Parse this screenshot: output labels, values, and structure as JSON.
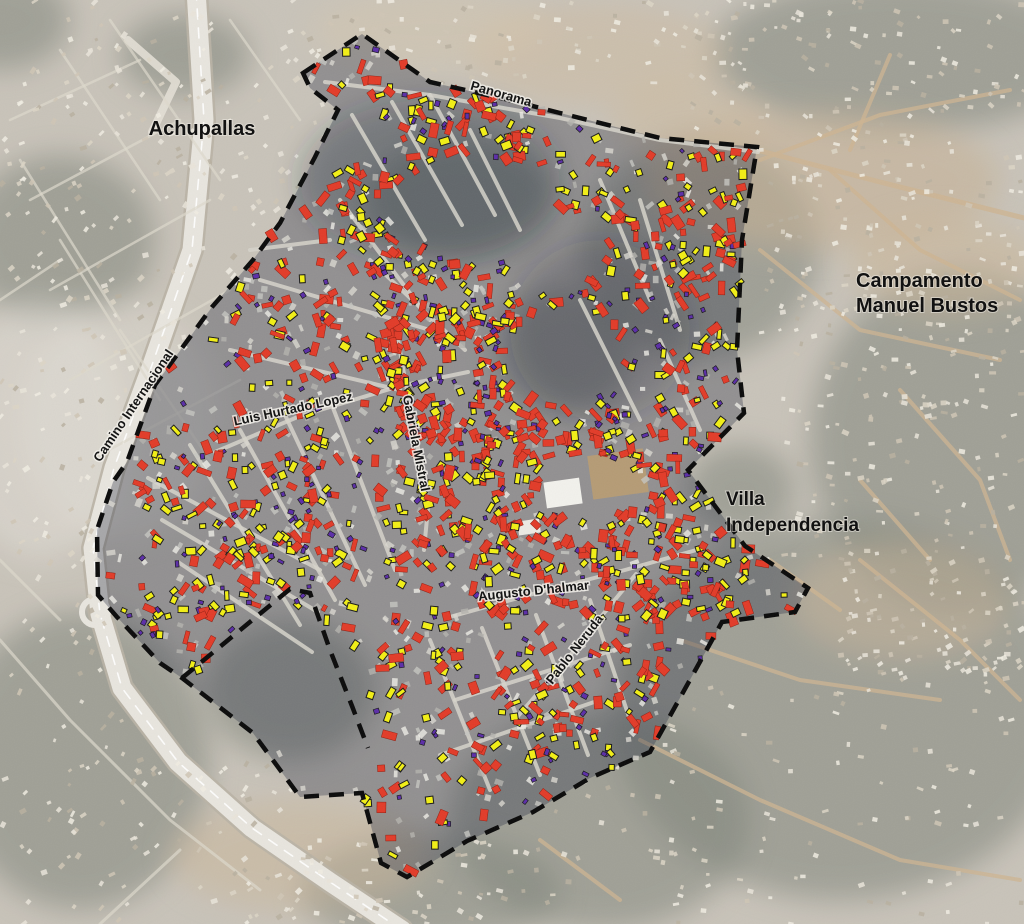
{
  "figure": {
    "type": "annotated-satellite-map",
    "area_labels": [
      {
        "id": "achupallas",
        "text": "Achupallas",
        "x": 202,
        "y": 135,
        "font_size": 20,
        "anchor": "middle"
      },
      {
        "id": "campamento-manuel-bustos",
        "lines": [
          "Campamento",
          "Manuel Bustos"
        ],
        "x": 856,
        "y": 287,
        "line_height": 25,
        "font_size": 20,
        "anchor": "start"
      },
      {
        "id": "villa-independencia",
        "lines": [
          "Villa",
          "Independencia"
        ],
        "x": 726,
        "y": 505,
        "line_height": 26,
        "font_size": 19,
        "anchor": "start"
      }
    ],
    "road_labels": [
      {
        "id": "panorama",
        "text": "Panorama",
        "x": 500,
        "y": 98,
        "rotate": 16,
        "font_size": 13
      },
      {
        "id": "camino-internacional",
        "text": "Camino Internacional",
        "x": 137,
        "y": 408,
        "rotate": -56,
        "font_size": 13
      },
      {
        "id": "luis-hurtado-lopez",
        "text": "Luis Hurtado Lopez",
        "x": 294,
        "y": 413,
        "rotate": -12,
        "font_size": 13
      },
      {
        "id": "gabriela-mistral",
        "text": "Gabriela Mistral",
        "x": 412,
        "y": 444,
        "rotate": 79,
        "font_size": 13
      },
      {
        "id": "augusto-dhalmar",
        "text": "Augusto D'halmar",
        "x": 534,
        "y": 595,
        "rotate": -6,
        "font_size": 13
      },
      {
        "id": "pablo-neruda",
        "text": "Pablo Neruda",
        "x": 578,
        "y": 652,
        "rotate": -52,
        "font_size": 13
      }
    ],
    "marker_colors": {
      "red": "#E23B28",
      "yellow": "#F2EF15",
      "purple": "#5B2DA8"
    },
    "boundary_color": "#0a0a0a",
    "boundary": [
      [
        303,
        73
      ],
      [
        362,
        34
      ],
      [
        430,
        82
      ],
      [
        505,
        99
      ],
      [
        560,
        113
      ],
      [
        660,
        138
      ],
      [
        757,
        147
      ],
      [
        742,
        240
      ],
      [
        737,
        350
      ],
      [
        744,
        413
      ],
      [
        688,
        470
      ],
      [
        745,
        546
      ],
      [
        808,
        588
      ],
      [
        795,
        612
      ],
      [
        722,
        622
      ],
      [
        650,
        752
      ],
      [
        590,
        778
      ],
      [
        533,
        812
      ],
      [
        467,
        841
      ],
      [
        407,
        877
      ],
      [
        381,
        863
      ],
      [
        362,
        793
      ],
      [
        300,
        797
      ],
      [
        253,
        733
      ],
      [
        182,
        678
      ],
      [
        160,
        663
      ],
      [
        117,
        617
      ],
      [
        98,
        595
      ],
      [
        97,
        530
      ],
      [
        113,
        482
      ],
      [
        127,
        462
      ],
      [
        155,
        385
      ],
      [
        182,
        348
      ],
      [
        212,
        307
      ],
      [
        253,
        260
      ],
      [
        280,
        223
      ],
      [
        315,
        157
      ],
      [
        338,
        110
      ],
      [
        310,
        88
      ]
    ],
    "notch": [
      [
        182,
        678
      ],
      [
        290,
        589
      ],
      [
        310,
        593
      ],
      [
        330,
        650
      ],
      [
        352,
        706
      ],
      [
        368,
        748
      ]
    ]
  }
}
